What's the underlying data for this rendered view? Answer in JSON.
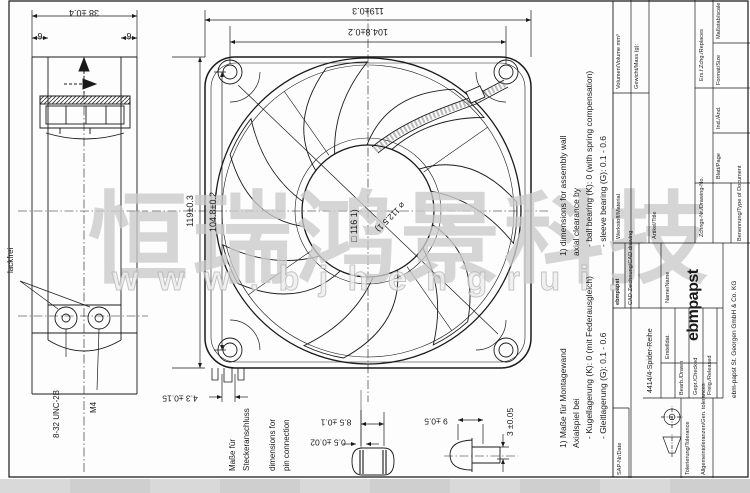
{
  "watermark": {
    "cjk": "恒瑞鸿景科技",
    "url": "w w w . b j h e n g r u i ."
  },
  "side_view": {
    "dim_depth": "38 ±0.4",
    "dim_flange_left": "6",
    "dim_flange_right": "6",
    "label_paint_free": "lackfrei",
    "thread_unc": "8-32 UNC-2B",
    "thread_m4": "M4"
  },
  "front_view": {
    "dim_width": "119±0.3",
    "dim_hole_spacing_h": "104.8±0.2",
    "dim_height": "119±0.3",
    "dim_hole_spacing_v": "104.8±0.2",
    "dim_square_opening": "□ 116 1)",
    "dim_circular_opening": "⌀ 112.5 1)",
    "dim_connector_offset": "4.3 ±0.15"
  },
  "pin_detail": {
    "label_de_1": "Maße für",
    "label_de_2": "Steckeranschluss",
    "label_en_1": "dimensions for",
    "label_en_2": "pin connection",
    "dim_pin_spacing": "8.5 ±0.1",
    "dim_pin_thickness": "0.5 ±0.02"
  },
  "screw_detail": {
    "dim_head_dia": "9 ±0.5",
    "dim_head_height": "3 ±0.05"
  },
  "notes_en": [
    "1) dimensions for assembly wall",
    "axial clearance by",
    "- ball bearing (K): 0 (with spring compensation)",
    "- sleeve bearing (G): 0.1 - 0.6"
  ],
  "notes_de": [
    "1) Maße für Montagewand",
    "Axialspiel bei",
    "- Kugellagerung (K): 0 (mit Federausgleich)",
    "- Gleitlagerung (G): 0.1 - 0.6"
  ],
  "title_block": {
    "material_label": "Werkstoff/Material",
    "volume_label": "Volumen/Volume mm³",
    "mass_label": "Gewicht/Mass (g):",
    "article_label": "Artikel/Title",
    "series": "4414/4-Spider-Reihe",
    "drawing_no_label": "Zchngs-Nr./Drawing-No.",
    "doc_type_label": "Benennung/Type of Document",
    "doc_type_value": "CAD-Zeichnung/CAD drawing",
    "replaces_label": "Ers.f.Zchg./Replaces",
    "scale_label": "Maßstab/scale",
    "format_label": "Format/Size",
    "index_label": "Ind./Änd.",
    "page_label": "Blatt/Page",
    "drawn_label": "Bearb./Drawn",
    "checked_label": "Gepr./Checked",
    "released_label": "Freig./Released",
    "created_label": "Erstelldat.",
    "name_label": "Name/Name",
    "sap_label": "SAP-Nr/Date",
    "tolerance_label": "Tolerierung/Tolerance",
    "gen_tol_label": "Allgemeintoleranzen/Gen. tolerances",
    "brand": "ebmpapst",
    "brand_small": "ebmpapst",
    "company": "ebm-papst St. Georgen GmbH & Co. KG"
  }
}
